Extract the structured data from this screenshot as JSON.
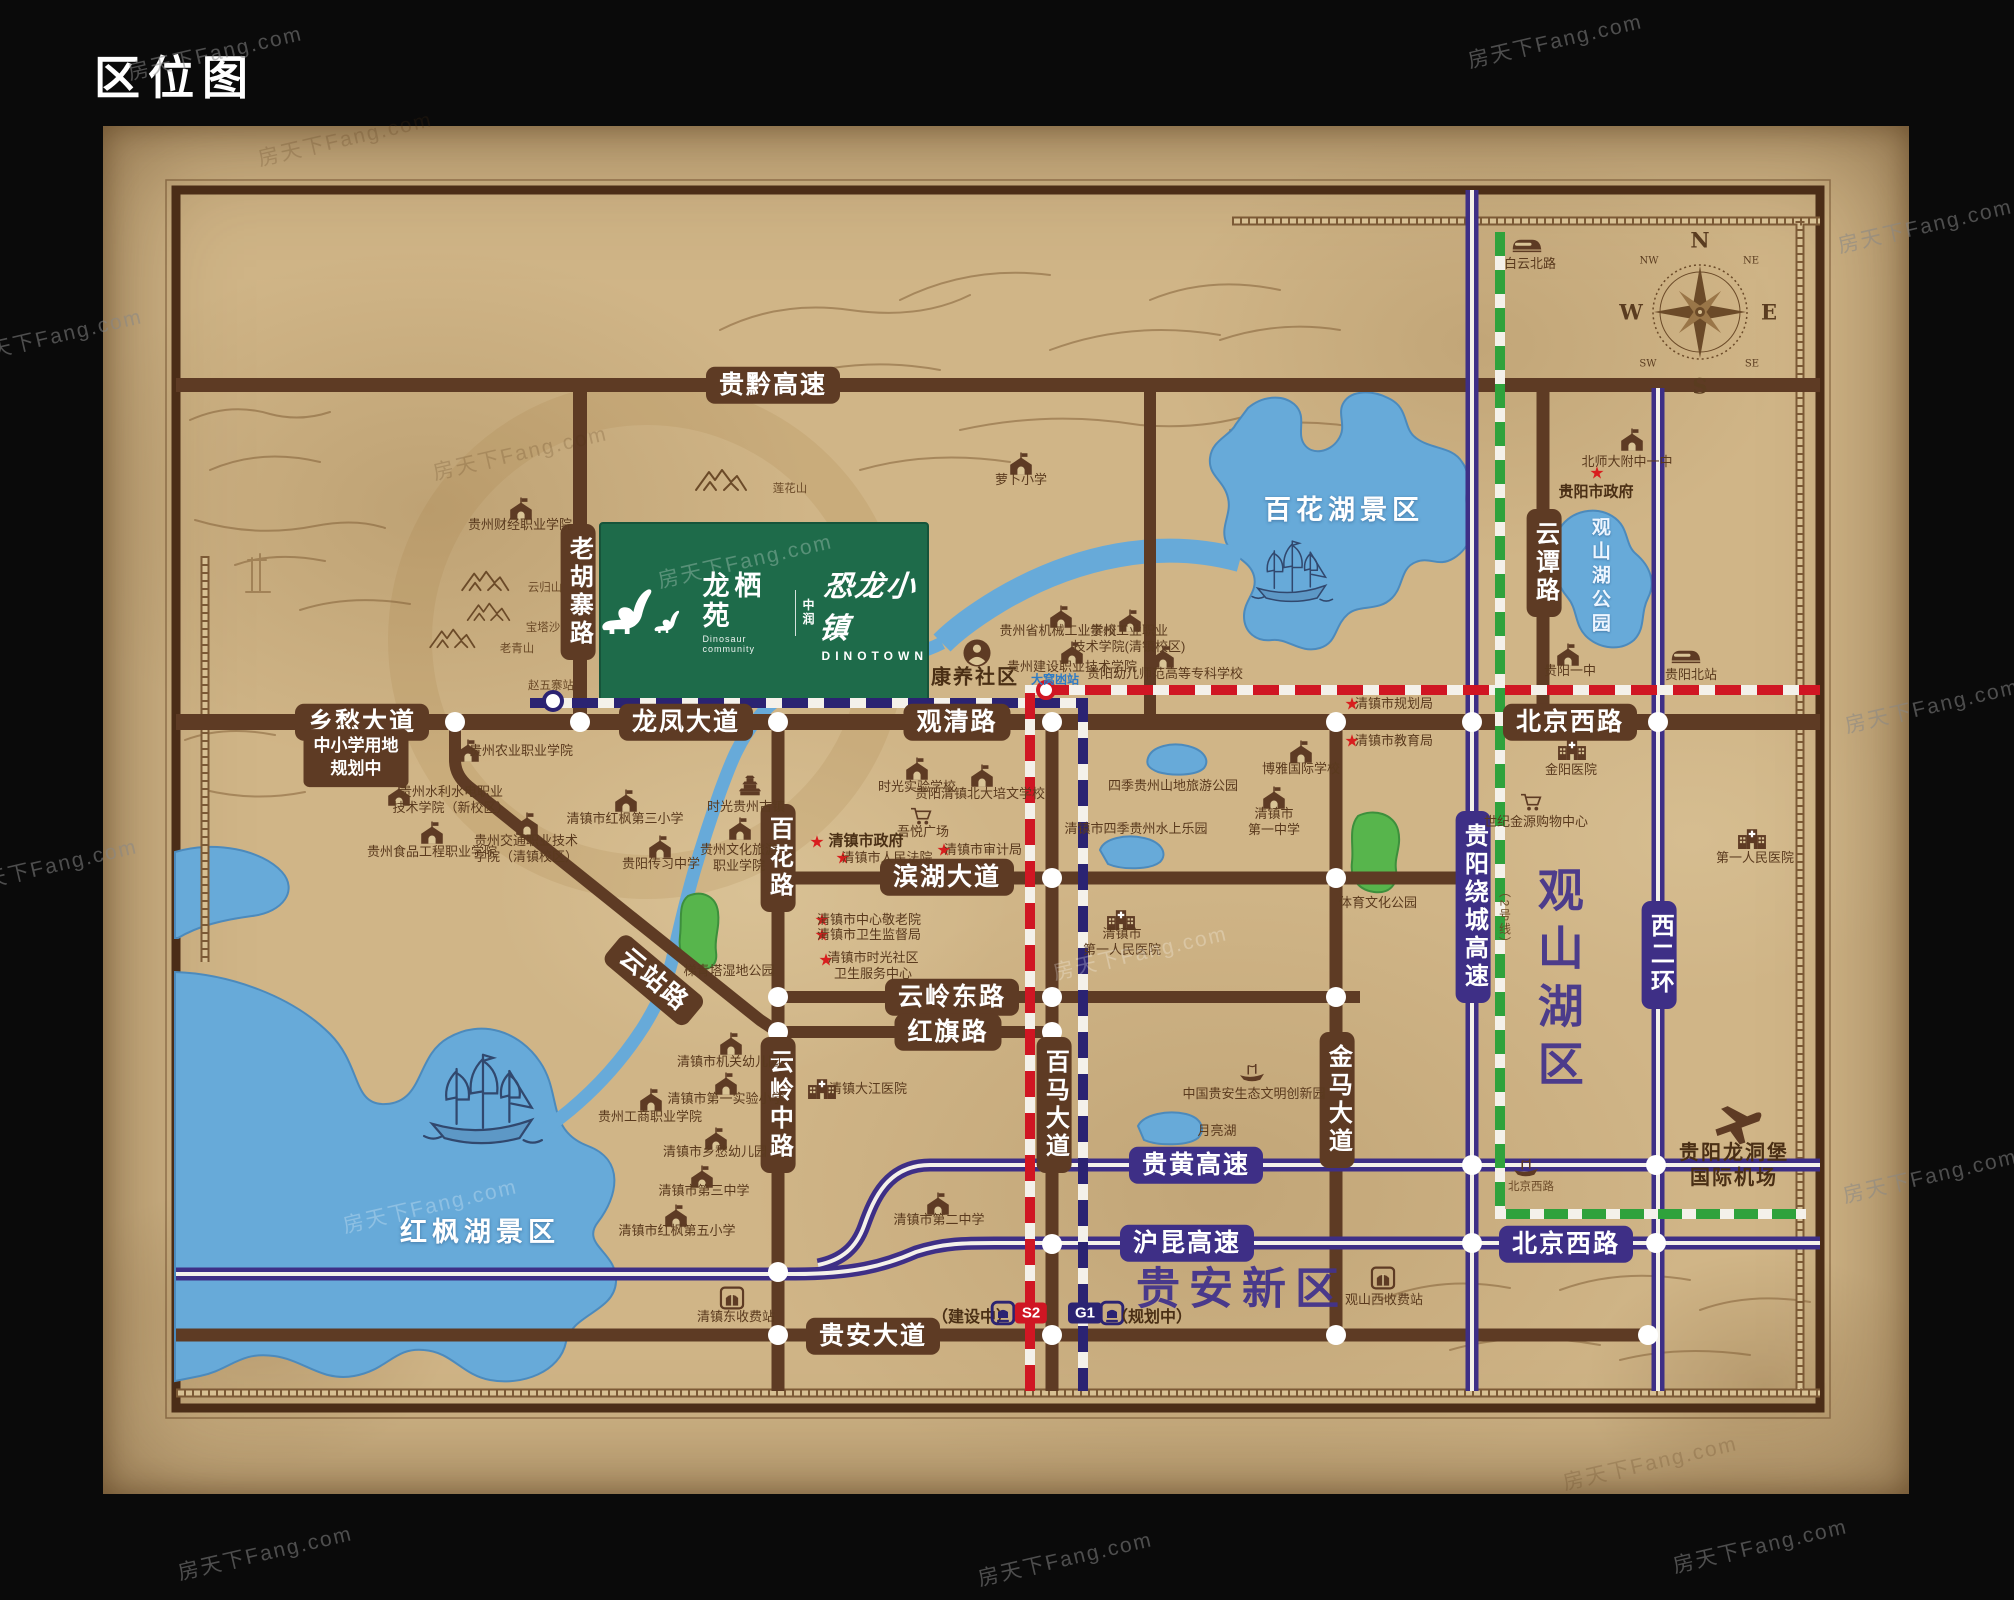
{
  "title": "区位图",
  "watermark": {
    "text": "房天下Fang.com",
    "spots": [
      {
        "x": 215,
        "y": 52,
        "k": "b"
      },
      {
        "x": 1555,
        "y": 40,
        "k": "b"
      },
      {
        "x": 1925,
        "y": 225,
        "k": "b"
      },
      {
        "x": 1932,
        "y": 705,
        "k": "b"
      },
      {
        "x": 1930,
        "y": 1175,
        "k": "b"
      },
      {
        "x": 55,
        "y": 335,
        "k": "b"
      },
      {
        "x": 50,
        "y": 865,
        "k": "b"
      },
      {
        "x": 265,
        "y": 1552,
        "k": "b"
      },
      {
        "x": 1065,
        "y": 1558,
        "k": "b"
      },
      {
        "x": 1760,
        "y": 1545,
        "k": "b"
      },
      {
        "x": 345,
        "y": 138,
        "k": "d"
      },
      {
        "x": 520,
        "y": 452,
        "k": "d"
      },
      {
        "x": 1650,
        "y": 1462,
        "k": "d"
      },
      {
        "x": 745,
        "y": 560,
        "k": "l"
      },
      {
        "x": 430,
        "y": 1205,
        "k": "l"
      },
      {
        "x": 1140,
        "y": 952,
        "k": "l"
      }
    ]
  },
  "logo": {
    "name_cn": "龙栖苑",
    "name_en": "Dinosaur community",
    "brand": "中润",
    "project": "恐龙小镇",
    "project_en": "DINOTOWN"
  },
  "legend": {
    "under_construction": "（建设中）",
    "s2": "S2",
    "g1": "G1",
    "planned": "（规划中）"
  },
  "compass": {
    "pts": [
      {
        "t": "N",
        "x": 1700,
        "y": 240,
        "s": "cm"
      },
      {
        "t": "S",
        "x": 1700,
        "y": 386,
        "s": "cm"
      },
      {
        "t": "E",
        "x": 1769,
        "y": 312,
        "s": "cm"
      },
      {
        "t": "W",
        "x": 1631,
        "y": 312,
        "s": "cm"
      },
      {
        "t": "NE",
        "x": 1751,
        "y": 261,
        "s": "cm cms"
      },
      {
        "t": "NW",
        "x": 1649,
        "y": 261,
        "s": "cm cms"
      },
      {
        "t": "SE",
        "x": 1752,
        "y": 364,
        "s": "cm cms"
      },
      {
        "t": "SW",
        "x": 1648,
        "y": 364,
        "s": "cm cms"
      }
    ]
  },
  "map": {
    "labels": [
      {
        "t": "贵黔高速",
        "x": 773,
        "y": 385,
        "s": "rp"
      },
      {
        "t": "乡愁大道",
        "x": 362,
        "y": 722,
        "s": "rp"
      },
      {
        "t": "龙凤大道",
        "x": 686,
        "y": 722,
        "s": "rp"
      },
      {
        "t": "观清路",
        "x": 957,
        "y": 722,
        "s": "rp"
      },
      {
        "t": "北京西路",
        "x": 1570,
        "y": 722,
        "s": "rp"
      },
      {
        "t": "滨湖大道",
        "x": 947,
        "y": 877,
        "s": "rp"
      },
      {
        "t": "云岭东路",
        "x": 952,
        "y": 997,
        "s": "rp"
      },
      {
        "t": "红旗路",
        "x": 948,
        "y": 1032,
        "s": "rp"
      },
      {
        "t": "贵安大道",
        "x": 873,
        "y": 1336,
        "s": "rp"
      },
      {
        "t": "云站路",
        "x": 654,
        "y": 980,
        "s": "rp",
        "r": 40
      },
      {
        "t": "老胡寨路",
        "x": 578,
        "y": 592,
        "s": "rpv"
      },
      {
        "t": "百花路",
        "x": 778,
        "y": 858,
        "s": "rpv"
      },
      {
        "t": "云岭中路",
        "x": 778,
        "y": 1105,
        "s": "rpv"
      },
      {
        "t": "百马大道",
        "x": 1054,
        "y": 1105,
        "s": "rpv"
      },
      {
        "t": "金马大道",
        "x": 1337,
        "y": 1100,
        "s": "rpv"
      },
      {
        "t": "云谭路",
        "x": 1544,
        "y": 563,
        "s": "rpv"
      },
      {
        "t": "中小学用地\n规划中",
        "x": 356,
        "y": 758,
        "s": "box"
      },
      {
        "t": "贵黄高速",
        "x": 1196,
        "y": 1165,
        "s": "hp"
      },
      {
        "t": "沪昆高速",
        "x": 1187,
        "y": 1243,
        "s": "hp"
      },
      {
        "t": "北京西路",
        "x": 1566,
        "y": 1244,
        "s": "hp"
      },
      {
        "t": "贵阳绕城高速",
        "x": 1473,
        "y": 907,
        "s": "hpv"
      },
      {
        "t": "西二环",
        "x": 1659,
        "y": 955,
        "s": "hpv"
      },
      {
        "t": "百花湖景区",
        "x": 1344,
        "y": 511,
        "s": "wt"
      },
      {
        "t": "红枫湖景区",
        "x": 480,
        "y": 1233,
        "s": "wt"
      },
      {
        "t": "观山湖公园",
        "x": 1599,
        "y": 577,
        "s": "wtv"
      },
      {
        "t": "观山湖区",
        "x": 1557,
        "y": 982,
        "s": "pbv"
      },
      {
        "t": "贵安新区",
        "x": 1242,
        "y": 1289,
        "s": "pb"
      },
      {
        "t": "康养社区",
        "x": 975,
        "y": 678,
        "s": "big"
      },
      {
        "t": "（2号线）",
        "x": 1504,
        "y": 918,
        "s": "tbv"
      },
      {
        "t": "四季贵州山地旅游公园",
        "x": 1173,
        "y": 786,
        "s": "mn"
      },
      {
        "t": "清镇市四季贵州水上乐园",
        "x": 1136,
        "y": 829,
        "s": "mn"
      },
      {
        "t": "月亮湖",
        "x": 1217,
        "y": 1131,
        "s": "mn"
      },
      {
        "t": "体育文化公园",
        "x": 1378,
        "y": 903,
        "s": "mn"
      },
      {
        "t": "梯青塔湿地公园",
        "x": 729,
        "y": 971,
        "s": "mn"
      },
      {
        "t": "云归山",
        "x": 545,
        "y": 588,
        "s": "tb"
      },
      {
        "t": "宝塔沙",
        "x": 543,
        "y": 628,
        "s": "tb"
      },
      {
        "t": "老青山",
        "x": 517,
        "y": 649,
        "s": "tb"
      },
      {
        "t": "莲花山",
        "x": 790,
        "y": 489,
        "s": "tb"
      },
      {
        "t": "赵五寨站",
        "x": 551,
        "y": 686,
        "s": "tb"
      },
      {
        "t": "大窝凼站",
        "x": 1055,
        "y": 680,
        "s": "tblue"
      }
    ],
    "pois": [
      {
        "i": "school",
        "x": 521,
        "y": 509,
        "t": "贵州财经职业学院",
        "tx": 520,
        "ty": 525
      },
      {
        "i": "school",
        "x": 1021,
        "y": 464,
        "t": "萝卜小学",
        "tx": 1021,
        "ty": 480
      },
      {
        "i": "school",
        "x": 468,
        "y": 751,
        "t": "贵州农业职业学院",
        "tx": 521,
        "ty": 751
      },
      {
        "i": "school",
        "x": 399,
        "y": 795,
        "t": "贵州水利水电职业\n技术学院（新校区）",
        "tx": 451,
        "ty": 800
      },
      {
        "i": "school",
        "x": 432,
        "y": 833,
        "t": "贵州食品工程职业学院",
        "tx": 432,
        "ty": 852
      },
      {
        "i": "school",
        "x": 527,
        "y": 824,
        "t": "贵州交通职业技术\n学院（清镇校区）",
        "tx": 526,
        "ty": 849
      },
      {
        "i": "school",
        "x": 626,
        "y": 801,
        "t": "清镇市红枫第三小学",
        "tx": 625,
        "ty": 819
      },
      {
        "i": "school",
        "x": 660,
        "y": 847,
        "t": "贵阳传习中学",
        "tx": 661,
        "ty": 864
      },
      {
        "i": "town",
        "x": 750,
        "y": 785,
        "t": "时光贵州古镇",
        "tx": 746,
        "ty": 807
      },
      {
        "i": "school",
        "x": 740,
        "y": 829,
        "t": "贵州文化旅游\n职业学院",
        "tx": 739,
        "ty": 858
      },
      {
        "i": "school",
        "x": 917,
        "y": 769,
        "t": "时光实验学校",
        "tx": 917,
        "ty": 787
      },
      {
        "i": "school",
        "x": 982,
        "y": 776,
        "t": "贵阳清镇北大培文学校",
        "tx": 980,
        "ty": 794
      },
      {
        "i": "school",
        "x": 1301,
        "y": 752,
        "t": "博雅国际学校",
        "tx": 1301,
        "ty": 769
      },
      {
        "i": "school",
        "x": 1274,
        "y": 798,
        "t": "清镇市\n第一中学",
        "tx": 1274,
        "ty": 822
      },
      {
        "i": "school",
        "x": 731,
        "y": 1044,
        "t": "清镇市机关幼儿园",
        "tx": 729,
        "ty": 1062
      },
      {
        "i": "school",
        "x": 726,
        "y": 1084,
        "t": "清镇市第一实验小学",
        "tx": 726,
        "ty": 1099
      },
      {
        "i": "school",
        "x": 651,
        "y": 1100,
        "t": "贵州工商职业学院",
        "tx": 650,
        "ty": 1117
      },
      {
        "i": "school",
        "x": 716,
        "y": 1139,
        "t": "清镇市乡愁幼儿园",
        "tx": 715,
        "ty": 1152
      },
      {
        "i": "school",
        "x": 702,
        "y": 1177,
        "t": "清镇市第三中学",
        "tx": 704,
        "ty": 1191
      },
      {
        "i": "school",
        "x": 676,
        "y": 1216,
        "t": "清镇市红枫第五小学",
        "tx": 677,
        "ty": 1231
      },
      {
        "i": "school",
        "x": 938,
        "y": 1204,
        "t": "清镇市第二中学",
        "tx": 939,
        "ty": 1220
      },
      {
        "i": "hospital",
        "x": 822,
        "y": 1088,
        "t": "清镇大江医院",
        "tx": 868,
        "ty": 1089
      },
      {
        "i": "hospital",
        "x": 1121,
        "y": 919,
        "t": "清镇市\n第一人民医院",
        "tx": 1122,
        "ty": 942
      },
      {
        "i": "school",
        "x": 1061,
        "y": 617,
        "t": "贵州省机械工业学校",
        "tx": 1058,
        "ty": 631
      },
      {
        "i": "school",
        "x": 1130,
        "y": 621,
        "t": "贵州工业职业\n技术学院(清镇校区)",
        "tx": 1129,
        "ty": 639
      },
      {
        "i": "school",
        "x": 1072,
        "y": 653,
        "t": "贵州建设职业技术学院",
        "tx": 1072,
        "ty": 667
      },
      {
        "i": "school",
        "x": 1163,
        "y": 657,
        "t": "贵阳幼儿师范高等专科学校",
        "tx": 1165,
        "ty": 674
      },
      {
        "i": "person",
        "x": 977,
        "y": 653
      },
      {
        "i": "school",
        "x": 1632,
        "y": 440,
        "t": "北师大附中一中",
        "tx": 1627,
        "ty": 462
      },
      {
        "i": "train",
        "x": 1527,
        "y": 245,
        "t": "白云北路",
        "tx": 1530,
        "ty": 264
      },
      {
        "i": "school",
        "x": 1568,
        "y": 655,
        "t": "贵阳一中",
        "tx": 1570,
        "ty": 671
      },
      {
        "i": "train",
        "x": 1686,
        "y": 656,
        "t": "贵阳北站",
        "tx": 1691,
        "ty": 675
      },
      {
        "i": "hospital",
        "x": 1572,
        "y": 749,
        "t": "金阳医院",
        "tx": 1571,
        "ty": 770
      },
      {
        "i": "cart",
        "x": 1531,
        "y": 802,
        "t": "世纪金源购物中心",
        "tx": 1536,
        "ty": 822
      },
      {
        "i": "hospital",
        "x": 1752,
        "y": 838,
        "t": "第一人民医院",
        "tx": 1755,
        "ty": 858
      },
      {
        "i": "cart",
        "x": 921,
        "y": 816,
        "t": "吾悦广场",
        "tx": 923,
        "ty": 832
      },
      {
        "i": "toll",
        "x": 1383,
        "y": 1278,
        "t": "观山西收费站",
        "tx": 1384,
        "ty": 1300
      },
      {
        "i": "toll",
        "x": 732,
        "y": 1298,
        "t": "清镇东收费站",
        "tx": 736,
        "ty": 1317
      },
      {
        "i": "plane",
        "x": 1736,
        "y": 1122,
        "t": "贵阳龙洞堡\n国际机场",
        "tx": 1734,
        "ty": 1166,
        "ts": "big"
      },
      {
        "i": "boat",
        "x": 1526,
        "y": 1168,
        "t": "北京西路",
        "tx": 1531,
        "ty": 1187,
        "ts": "tb"
      },
      {
        "i": "boat",
        "x": 1252,
        "y": 1073,
        "t": "中国贵安生态文明创新园",
        "tx": 1254,
        "ty": 1094
      }
    ],
    "star_glyph": "★",
    "stars": [
      {
        "t": "清镇市政府",
        "sx": 817,
        "sy": 842,
        "tx": 866,
        "ty": 842,
        "b": 1
      },
      {
        "t": "清镇市人民法院",
        "sx": 843,
        "sy": 858,
        "tx": 887,
        "ty": 858
      },
      {
        "t": "清镇市审计局",
        "sx": 944,
        "sy": 850,
        "tx": 983,
        "ty": 850
      },
      {
        "t": "清镇市中心敬老院",
        "sx": 822,
        "sy": 920,
        "tx": 869,
        "ty": 920
      },
      {
        "t": "清镇市卫生监督局",
        "sx": 822,
        "sy": 935,
        "tx": 869,
        "ty": 935
      },
      {
        "t": "清镇市时光社区\n卫生服务中心",
        "sx": 826,
        "sy": 960,
        "tx": 873,
        "ty": 966
      },
      {
        "t": "清镇市规划局",
        "sx": 1352,
        "sy": 704,
        "tx": 1394,
        "ty": 704
      },
      {
        "t": "清镇市教育局",
        "sx": 1352,
        "sy": 741,
        "tx": 1394,
        "ty": 741
      },
      {
        "t": "贵阳市政府",
        "sx": 1597,
        "sy": 473,
        "tx": 1596,
        "ty": 493,
        "b": 1
      }
    ]
  }
}
